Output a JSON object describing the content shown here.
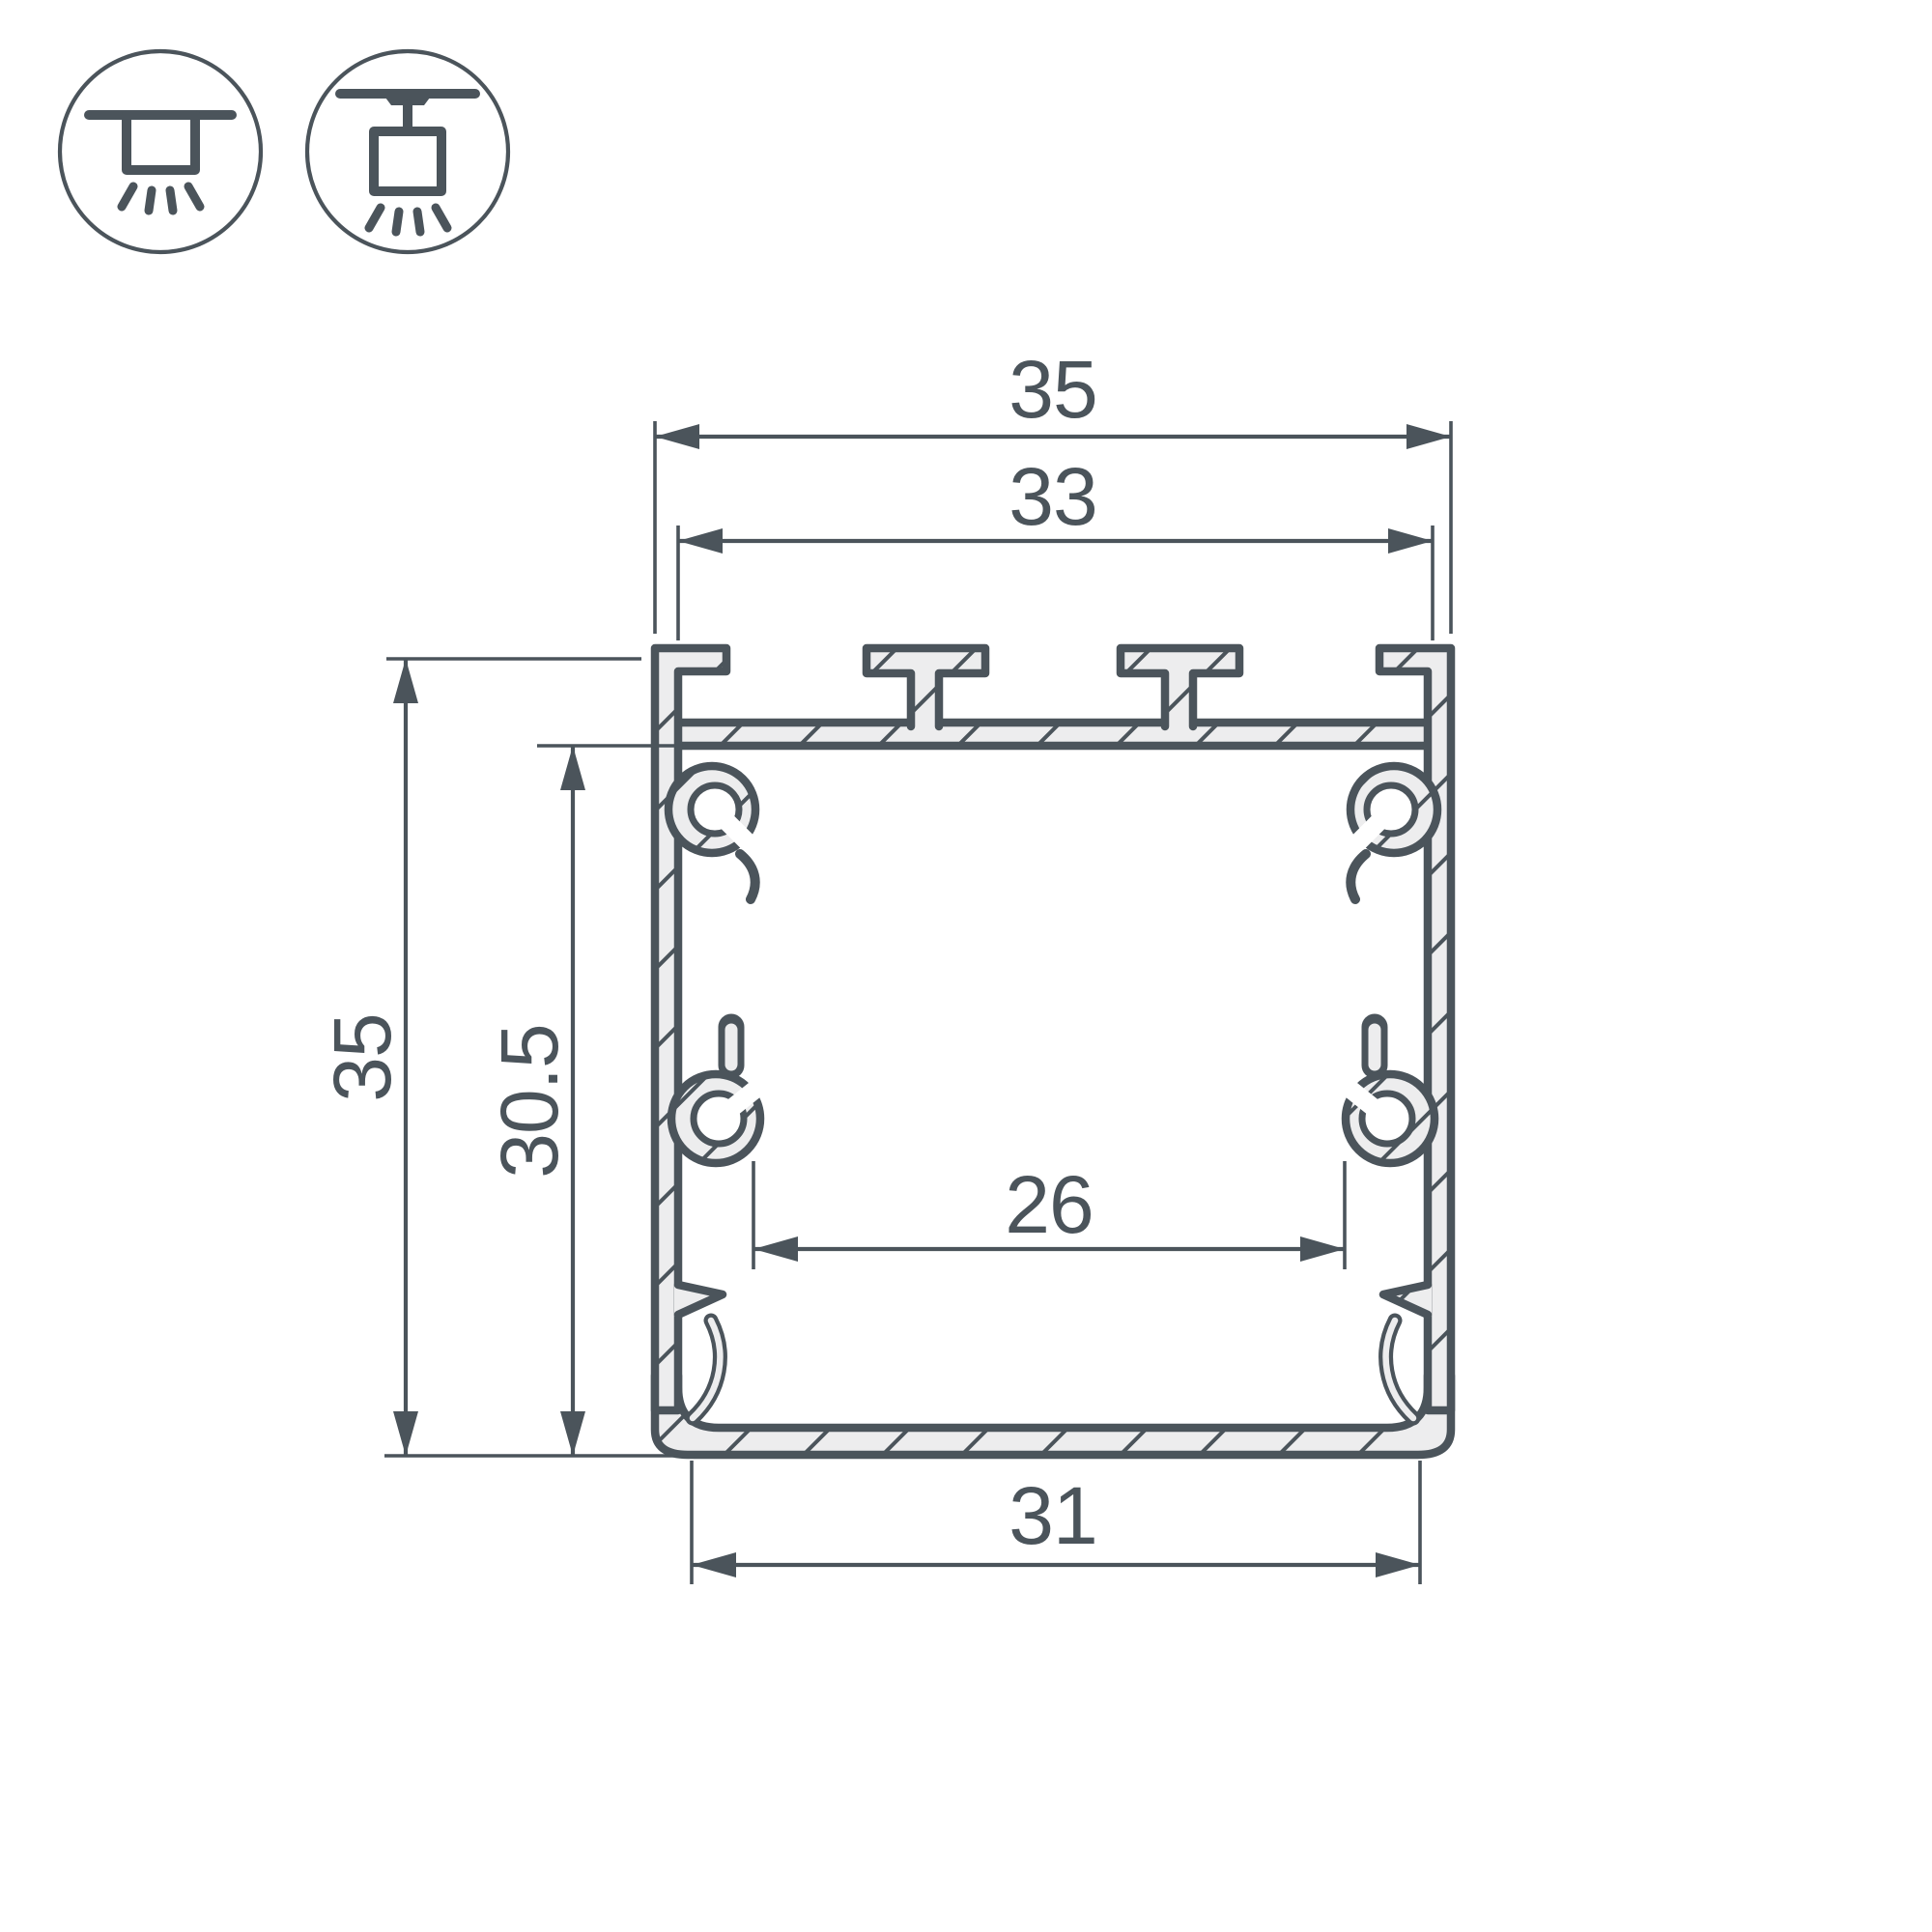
{
  "drawing": {
    "profile_dimensions": {
      "outer_width": "35",
      "top_groove_span": "33",
      "outer_height": "35",
      "inner_height": "30.5",
      "inner_width": "26",
      "bottom_width": "31"
    },
    "mounting_icons": {
      "left": "surface-ceiling-mount",
      "right": "suspended-ceiling-mount"
    },
    "colors": {
      "line": "#4b545b",
      "material_fill": "#ededee",
      "background": "#ffffff"
    }
  }
}
